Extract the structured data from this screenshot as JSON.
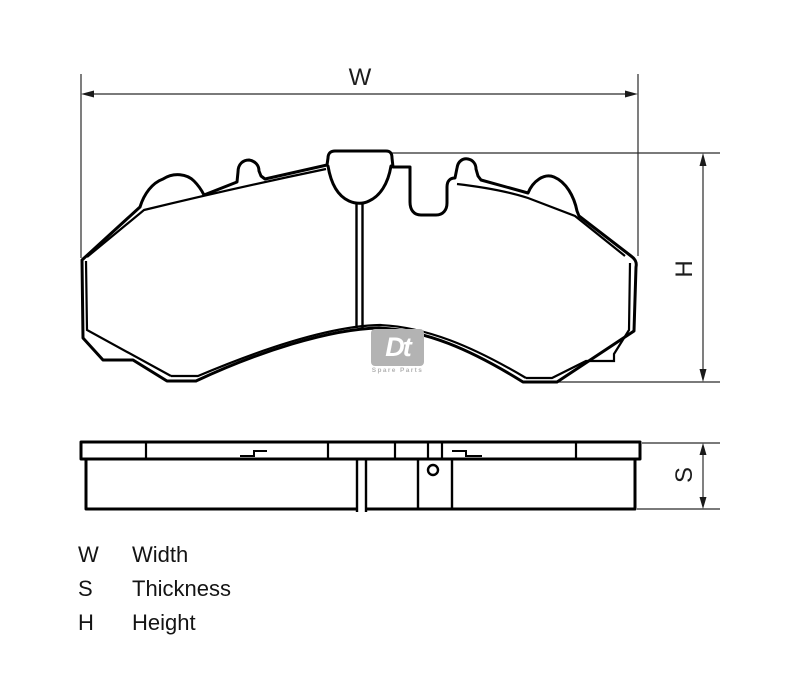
{
  "drawing": {
    "title": "Brake pad dimensional drawing",
    "dimensions": {
      "width_label": "W",
      "height_label": "H",
      "thickness_label": "S"
    },
    "legend": {
      "rows": [
        {
          "symbol": "W",
          "term": "Width"
        },
        {
          "symbol": "S",
          "term": "Thickness"
        },
        {
          "symbol": "H",
          "term": "Height"
        }
      ]
    },
    "watermark": {
      "brand": "Dt",
      "subtitle": "Spare Parts"
    },
    "colors": {
      "line": "#000000",
      "dimension_line": "#2a2a2a",
      "watermark": "#b3b3b3",
      "background": "#ffffff"
    }
  }
}
